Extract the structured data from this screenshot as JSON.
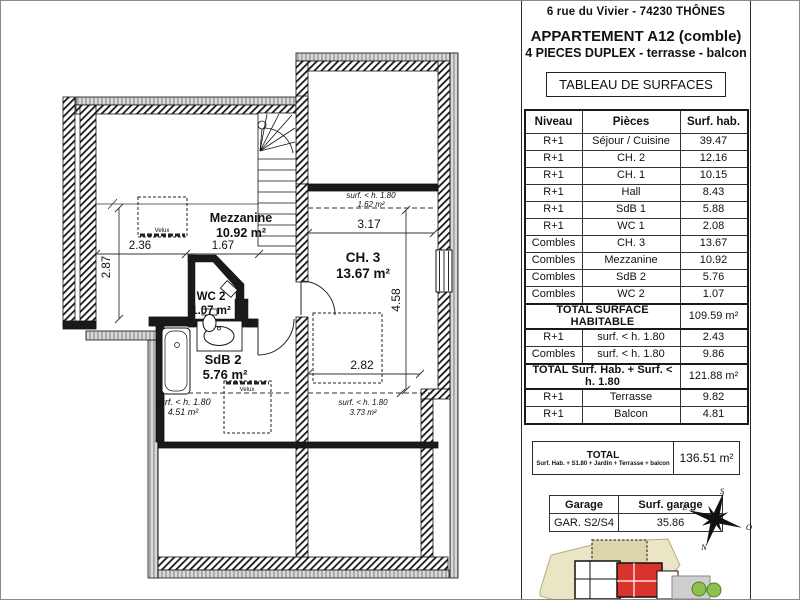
{
  "header": {
    "address": "6 rue du Vivier - 74230 THÔNES",
    "title": "APPARTEMENT A12 (comble)",
    "subtitle": "4 PIECES DUPLEX - terrasse - balcon",
    "table_title": "TABLEAU DE SURFACES"
  },
  "surface_table": {
    "columns": [
      "Niveau",
      "Pièces",
      "Surf. hab."
    ],
    "rows": [
      [
        "R+1",
        "Séjour / Cuisine",
        "39.47"
      ],
      [
        "R+1",
        "CH. 2",
        "12.16"
      ],
      [
        "R+1",
        "CH. 1",
        "10.15"
      ],
      [
        "R+1",
        "Hall",
        "8.43"
      ],
      [
        "R+1",
        "SdB 1",
        "5.88"
      ],
      [
        "R+1",
        "WC 1",
        "2.08"
      ],
      [
        "Combles",
        "CH. 3",
        "13.67"
      ],
      [
        "Combles",
        "Mezzanine",
        "10.92"
      ],
      [
        "Combles",
        "SdB 2",
        "5.76"
      ],
      [
        "Combles",
        "WC 2",
        "1.07"
      ]
    ],
    "total_habitable": {
      "label": "TOTAL SURFACE HABITABLE",
      "value": "109.59 m²"
    },
    "sub_rows": [
      [
        "R+1",
        "surf. < h. 1.80",
        "2.43"
      ],
      [
        "Combles",
        "surf. < h. 1.80",
        "9.86"
      ]
    ],
    "total_with_sub": {
      "label": "TOTAL Surf. Hab. + Surf. < h. 1.80",
      "value": "121.88 m²"
    },
    "annex_rows": [
      [
        "R+1",
        "Terrasse",
        "9.82"
      ],
      [
        "R+1",
        "Balcon",
        "4.81"
      ]
    ]
  },
  "grand_total": {
    "label": "TOTAL",
    "sublabel": "Surf. Hab. + S1.80 + Jardin + Terrasse + balcon",
    "value": "136.51 m²"
  },
  "garage_table": {
    "columns": [
      "Garage",
      "Surf. garage"
    ],
    "rows": [
      [
        "GAR. S2/S4",
        "35.86"
      ]
    ]
  },
  "compass": {
    "s": "S",
    "e": "E",
    "o": "O",
    "n": "N"
  },
  "floor_plan": {
    "rooms": [
      {
        "name": "Mezzanine",
        "area": "10.92 m²"
      },
      {
        "name": "CH. 3",
        "area": "13.67 m²"
      },
      {
        "name": "WC 2",
        "area": "1.07 m²"
      },
      {
        "name": "SdB 2",
        "area": "5.76 m²"
      }
    ],
    "low_height_zones": [
      {
        "label": "surf. < h. 1.80",
        "area": "1.62 m²"
      },
      {
        "label": "surf. < h. 1.80",
        "area": "3.73 m²"
      },
      {
        "label": "surf. < h. 1.80",
        "area": "4.51 m²"
      }
    ],
    "dimensions": [
      "2.36",
      "1.67",
      "2.87",
      "3.17",
      "4.58",
      "2.82"
    ],
    "velux_label": "Velux"
  },
  "colors": {
    "wall": "#1a1a1a",
    "masonry_gray": "#c4c4c4",
    "site_fill": "#eae5c4",
    "apartment_highlight": "#d9332e",
    "vegetation": "#8ec04e",
    "driveway": "#cfcfcf"
  }
}
